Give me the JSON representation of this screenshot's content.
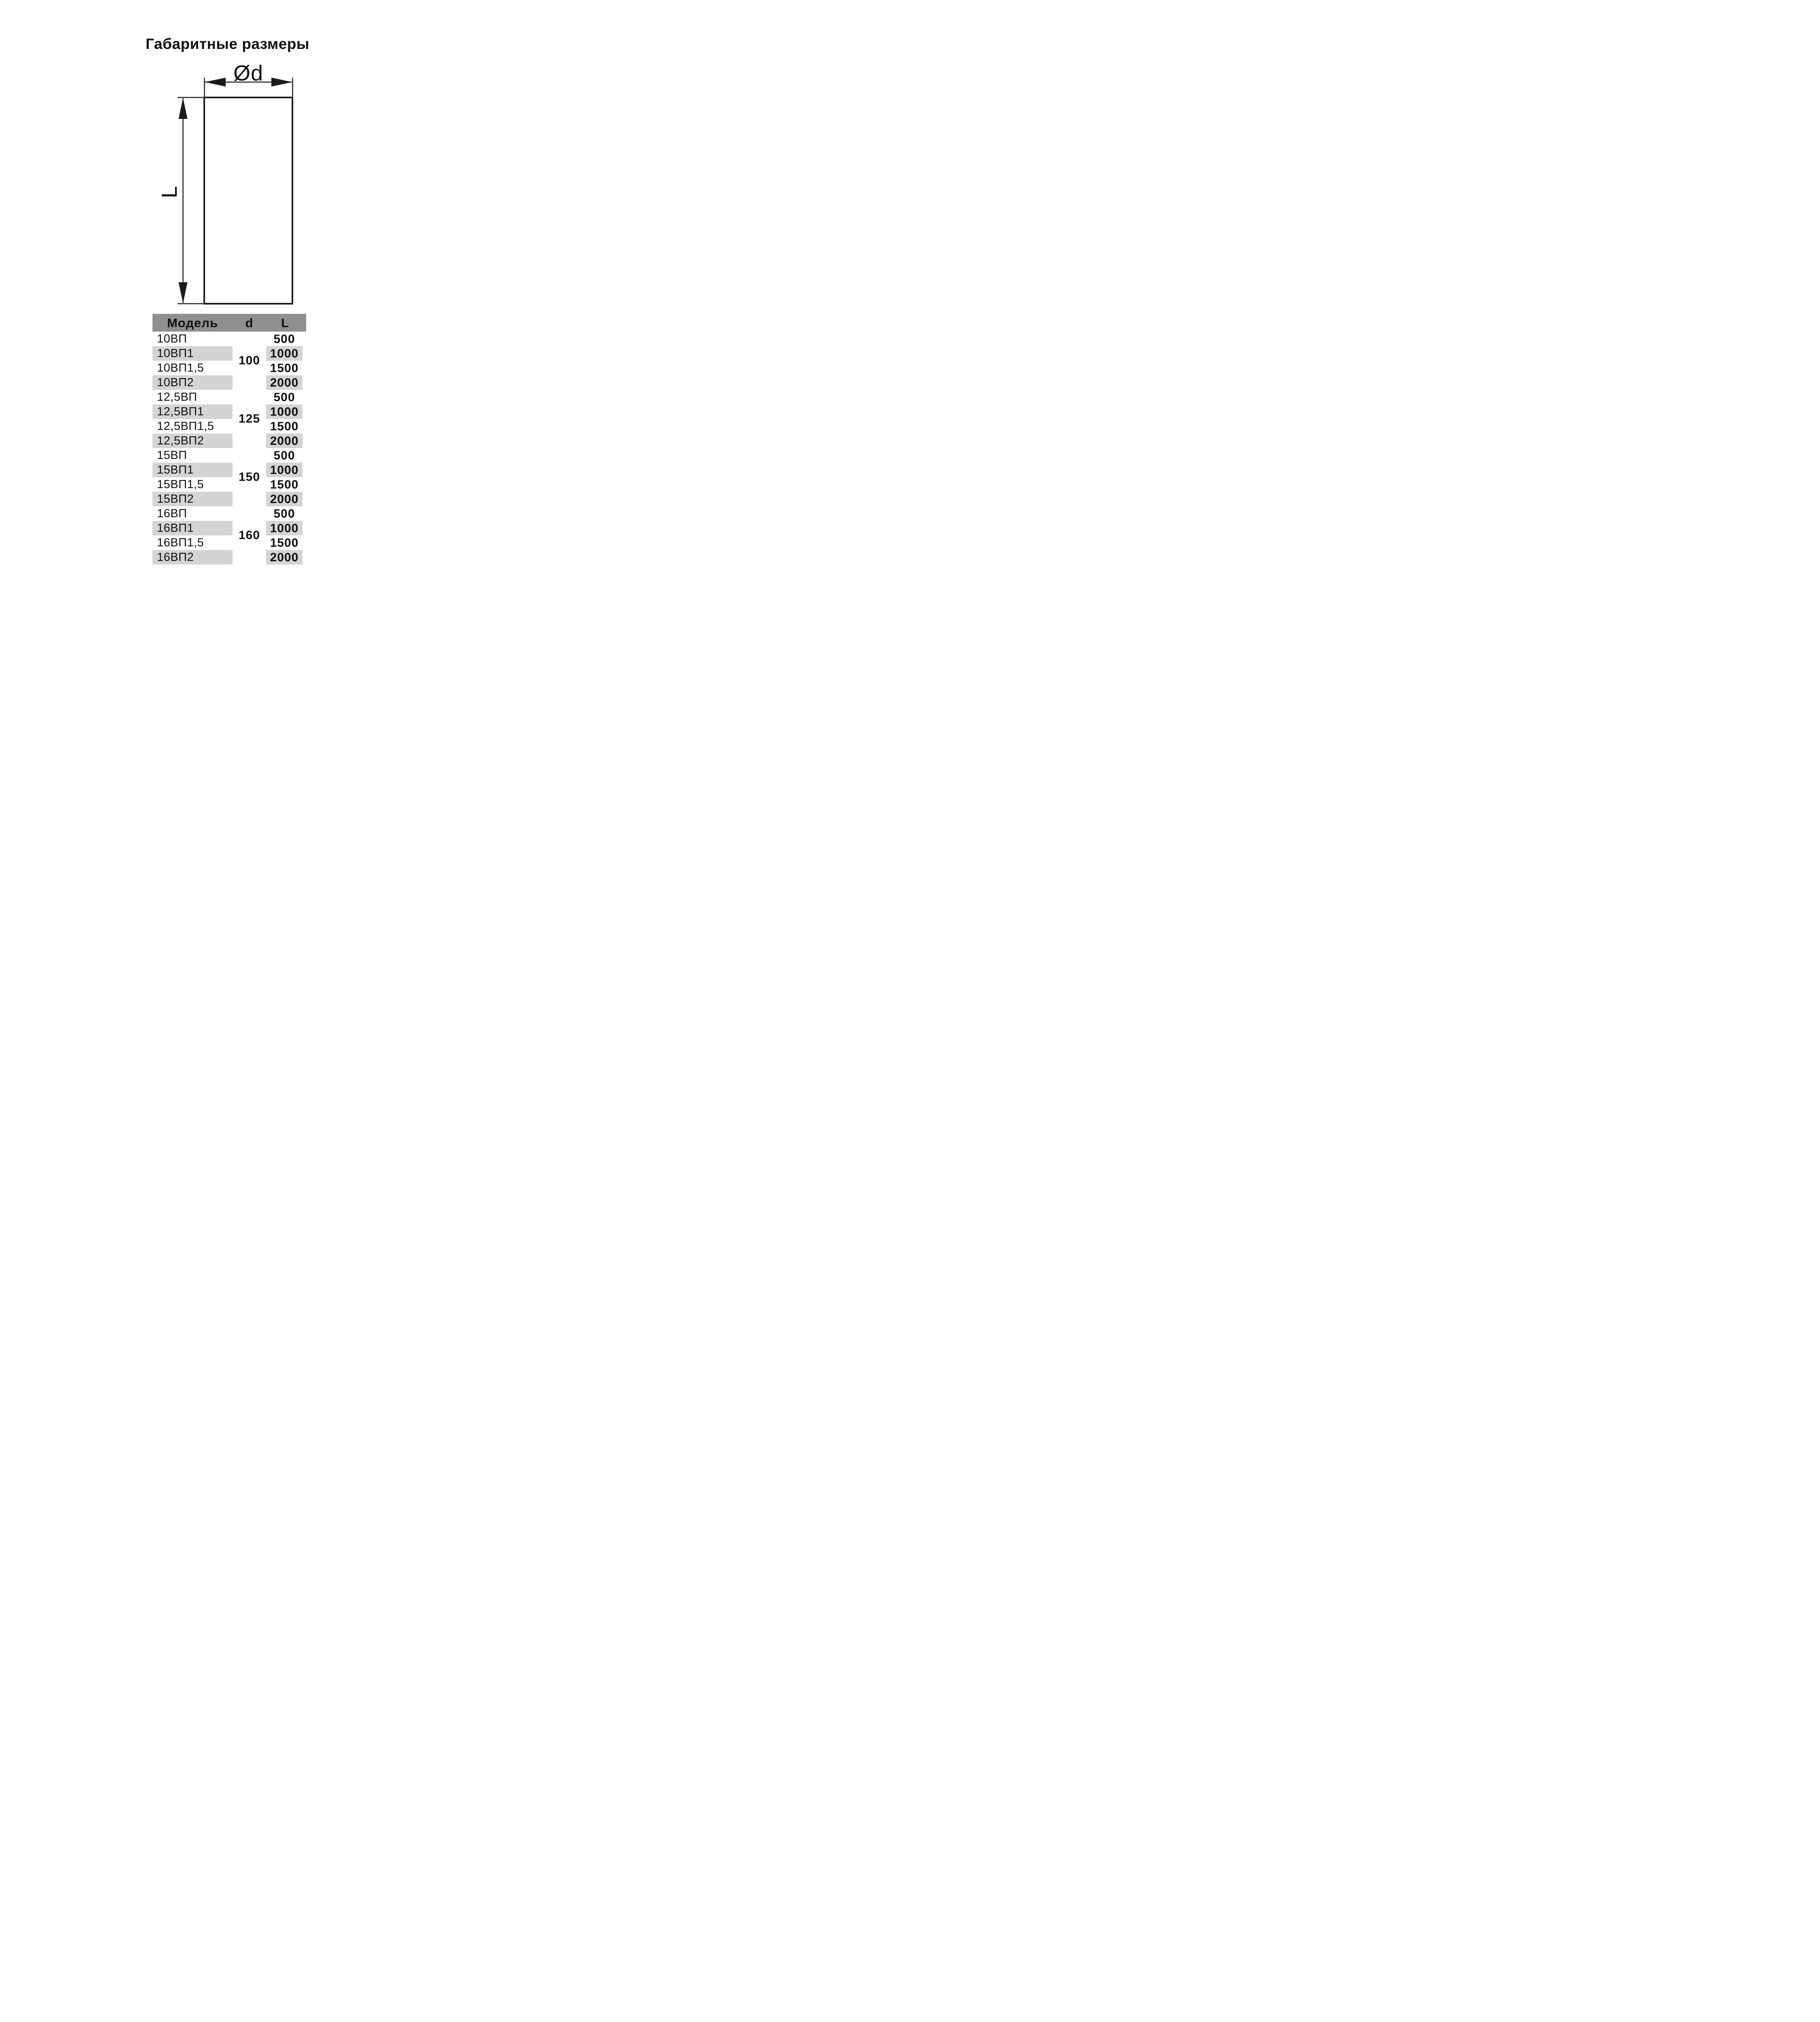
{
  "page": {
    "title": "Габаритные размеры"
  },
  "diagram": {
    "diameter_label": "Ød",
    "length_label": "L"
  },
  "table": {
    "header": {
      "model": "Модель",
      "d": "d",
      "l": "L"
    },
    "groups": [
      {
        "d": "100",
        "rows": [
          {
            "model": "10ВП",
            "l": "500"
          },
          {
            "model": "10ВП1",
            "l": "1000"
          },
          {
            "model": "10ВП1,5",
            "l": "1500"
          },
          {
            "model": "10ВП2",
            "l": "2000"
          }
        ]
      },
      {
        "d": "125",
        "rows": [
          {
            "model": "12,5ВП",
            "l": "500"
          },
          {
            "model": "12,5ВП1",
            "l": "1000"
          },
          {
            "model": "12,5ВП1,5",
            "l": "1500"
          },
          {
            "model": "12,5ВП2",
            "l": "2000"
          }
        ]
      },
      {
        "d": "150",
        "rows": [
          {
            "model": "15ВП",
            "l": "500"
          },
          {
            "model": "15ВП1",
            "l": "1000"
          },
          {
            "model": "15ВП1,5",
            "l": "1500"
          },
          {
            "model": "15ВП2",
            "l": "2000"
          }
        ]
      },
      {
        "d": "160",
        "rows": [
          {
            "model": "16ВП",
            "l": "500"
          },
          {
            "model": "16ВП1",
            "l": "1000"
          },
          {
            "model": "16ВП1,5",
            "l": "1500"
          },
          {
            "model": "16ВП2",
            "l": "2000"
          }
        ]
      }
    ]
  },
  "colors": {
    "header_bg": "#8f8f8f",
    "stripe_bg": "#d4d4d4",
    "ink": "#1a1a1a"
  }
}
